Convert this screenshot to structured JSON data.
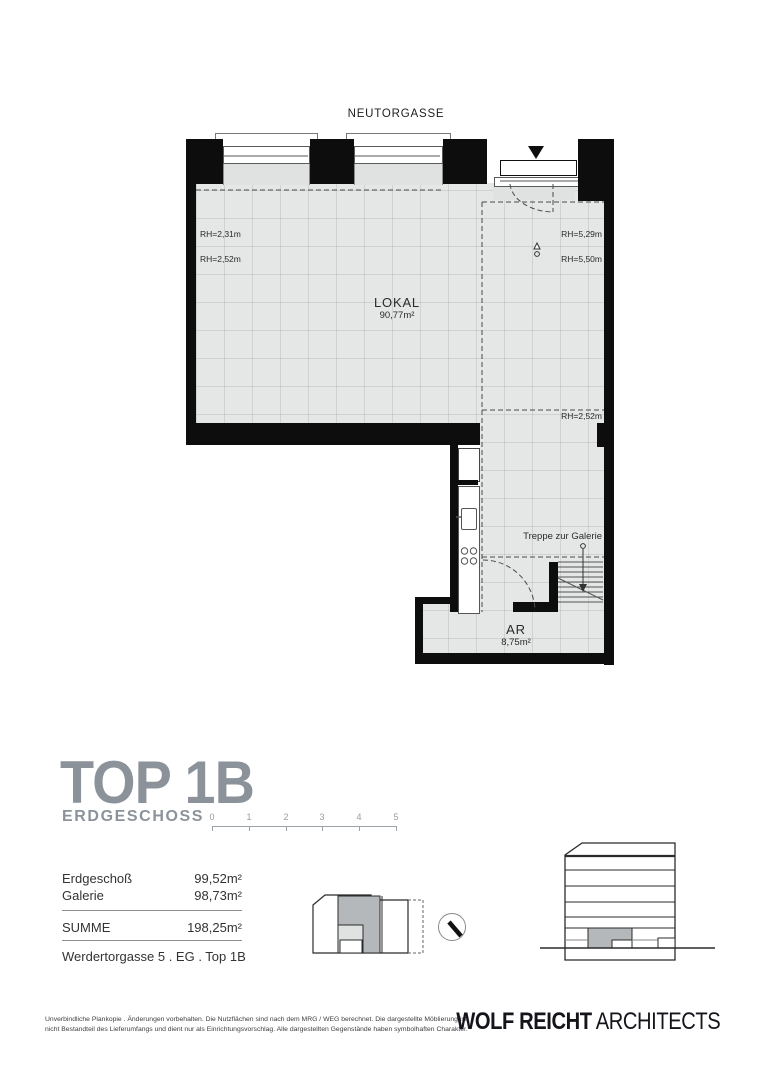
{
  "street_label": "NEUTORGASSE",
  "plan": {
    "lokal_name": "LOKAL",
    "lokal_area": "90,77m²",
    "ar_name": "AR",
    "ar_area": "8,75m²",
    "stairs_label": "Treppe zur Galerie",
    "rh_left_top": "RH=2,31m",
    "rh_left_bottom": "RH=2,52m",
    "rh_right_top": "RH=5,29m",
    "rh_right_bottom": "RH=5,50m",
    "rh_galerie": "RH=2,52m"
  },
  "title_block": {
    "title": "TOP 1B",
    "subtitle": "ERDGESCHOSS",
    "scale_labels": [
      "0",
      "1",
      "2",
      "3",
      "4",
      "5"
    ]
  },
  "area_table": {
    "rows": [
      {
        "label": "Erdgeschoß",
        "value": "99,52m²"
      },
      {
        "label": "Galerie",
        "value": "98,73m²"
      }
    ],
    "total_label": "SUMME",
    "total_value": "198,25m²",
    "address": "Werdertorgasse 5 . EG . Top 1B"
  },
  "footer": {
    "disclaimer_line1": "Unverbindliche Plankopie . Änderungen vorbehalten. Die Nutzflächen sind nach dem MRG / WEG berechnet. Die dargestellte Möblierung ist",
    "disclaimer_line2": "nicht Bestandteil des Lieferumfangs und dient nur als Einrichtungsvorschlag. Alle dargestellten Gegenstände haben symbolhaften Charakter.",
    "logo_bold": "WOLF REICHT",
    "logo_light": "ARCHITECTS"
  }
}
